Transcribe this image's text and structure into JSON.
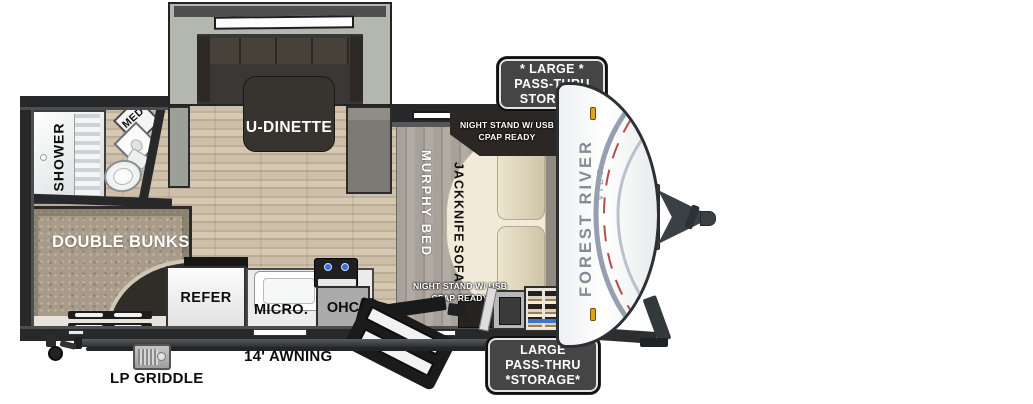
{
  "title": "Forest River Vibe travel trailer floor plan",
  "slideout": {
    "label": "U-DINETTE"
  },
  "bathroom": {
    "shower": "SHOWER",
    "med": "MED"
  },
  "bunks": {
    "label": "DOUBLE BUNKS"
  },
  "kitchen": {
    "refer": "REFER",
    "micro": "MICRO.",
    "ohc": "OHC"
  },
  "bedroom": {
    "murphy": "MURPHY BED",
    "sofa_line1": "JACKKNIFE",
    "sofa_line2": "SOFA",
    "nightstand_top": {
      "line1": "NIGHT STAND W/ USB",
      "line2": "CPAP READY"
    },
    "nightstand_bottom": {
      "line1": "NIGHT STAND W/ USB",
      "line2": "CPAP READY"
    }
  },
  "badges": {
    "top": {
      "line1": "* LARGE *",
      "line2": "PASS-THRU",
      "line3": "STORAGE"
    },
    "bottom": {
      "line1": "LARGE",
      "line2": "PASS-THRU",
      "line3": "*STORAGE*"
    }
  },
  "exterior": {
    "awning": "14' AWNING",
    "griddle": "LP GRIDDLE"
  },
  "brand": {
    "name": "FOREST RIVER",
    "model": "VIBE"
  },
  "colors": {
    "wall": "#26282a",
    "floor_wood": "#c8b9a3",
    "slide_frame": "#b4b7ad",
    "furniture_dark": "#37332f",
    "bunks_tan": "#a89b89",
    "sofa_cream": "#f1ead9",
    "cushion_beige": "#d9cfb4",
    "murphy_gray": "#a19b94",
    "badge_bg": "#454545",
    "clearance_amber": "#e2a31f",
    "stripe_slate": "#8a95a7",
    "stripe_red": "#b84b4b",
    "burner_blue": "#3f6fd6",
    "brand_gray": "#848a96"
  }
}
